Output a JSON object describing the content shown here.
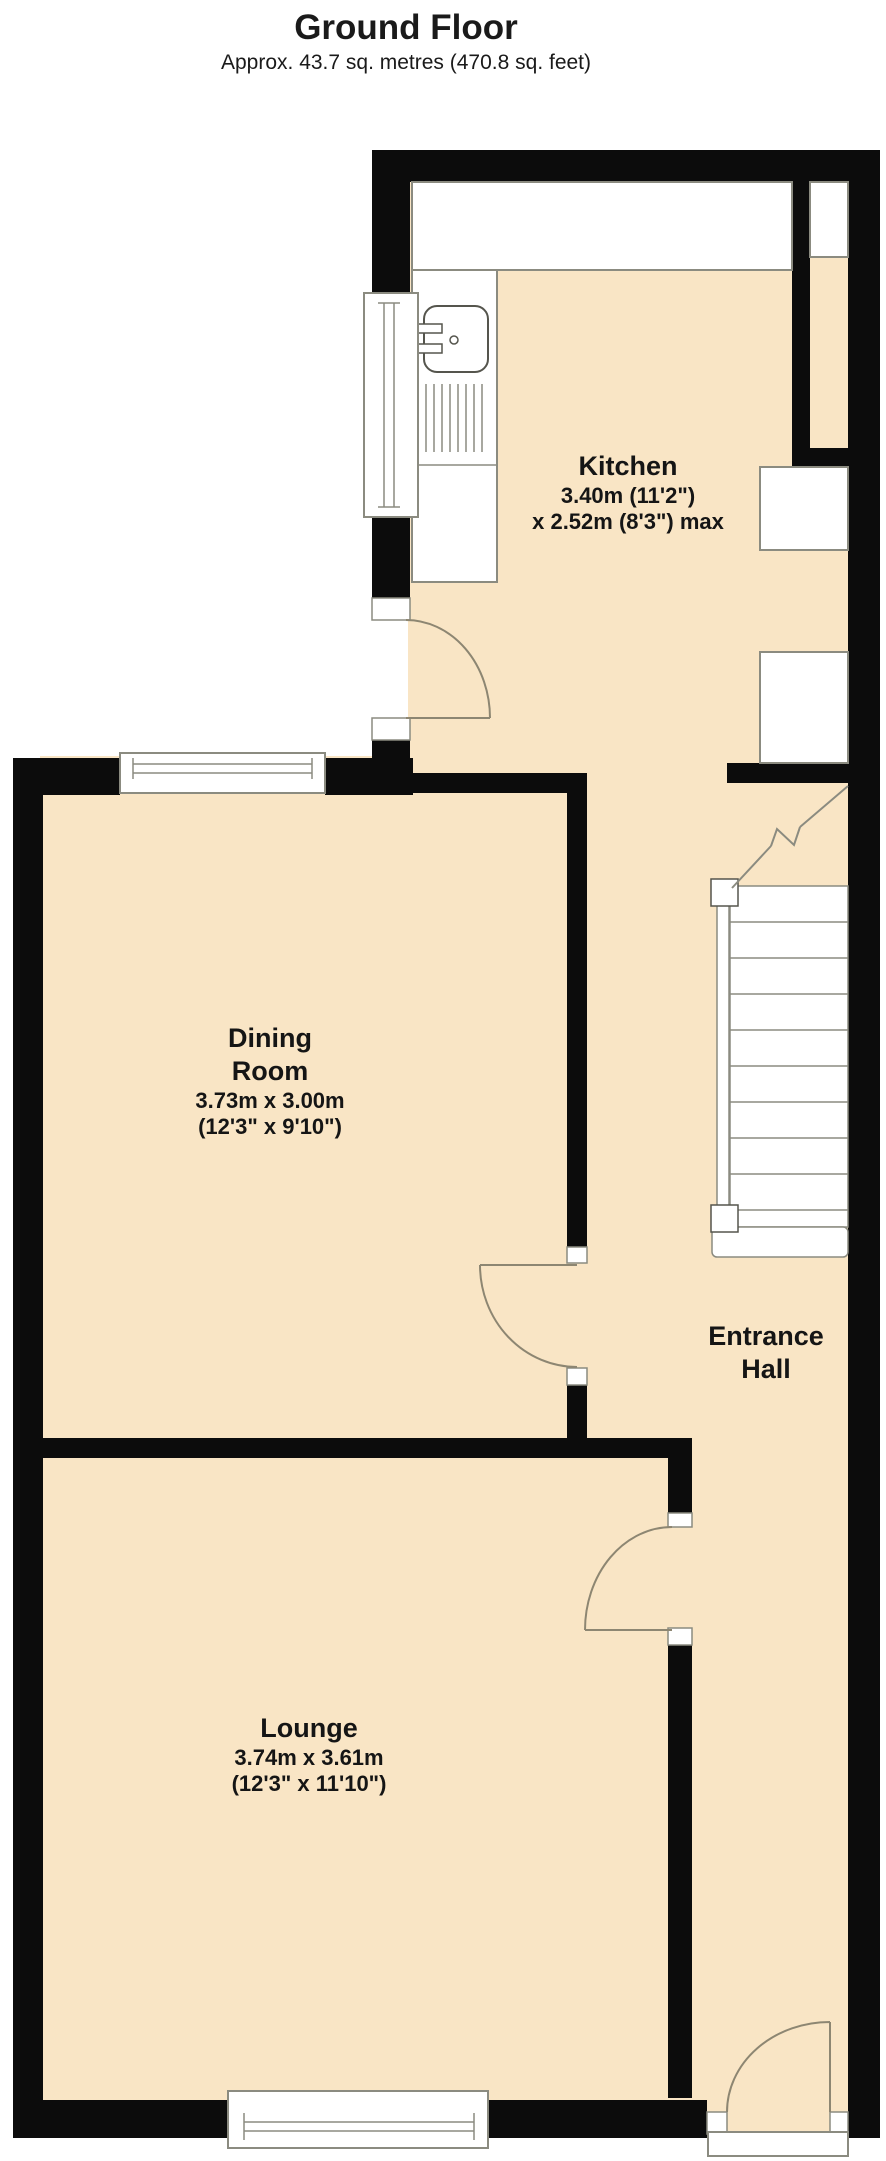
{
  "header": {
    "title": "Ground Floor",
    "subtitle": "Approx. 43.7 sq. metres (470.8 sq. feet)"
  },
  "rooms": {
    "kitchen": {
      "name": "Kitchen",
      "dim1": "3.40m (11'2\")",
      "dim2": "x 2.52m (8'3\") max"
    },
    "dining": {
      "name1": "Dining",
      "name2": "Room",
      "dim1": "3.73m x 3.00m",
      "dim2": "(12'3\" x 9'10\")"
    },
    "entrance": {
      "name1": "Entrance",
      "name2": "Hall"
    },
    "lounge": {
      "name": "Lounge",
      "dim1": "3.74m x 3.61m",
      "dim2": "(12'3\" x 11'10\")"
    }
  },
  "icons": {
    "sink": "sink-icon",
    "stairs": "stairs-icon",
    "window": "window-symbol",
    "door": "door-swing-symbol"
  },
  "colors": {
    "floor": "#f9e5c5",
    "wall": "#0c0c0c",
    "fixture_fill": "#ffffff",
    "fixture_outline": "#8b8b80",
    "door_arc": "#8d8672",
    "text": "#151515",
    "background": "#ffffff"
  }
}
